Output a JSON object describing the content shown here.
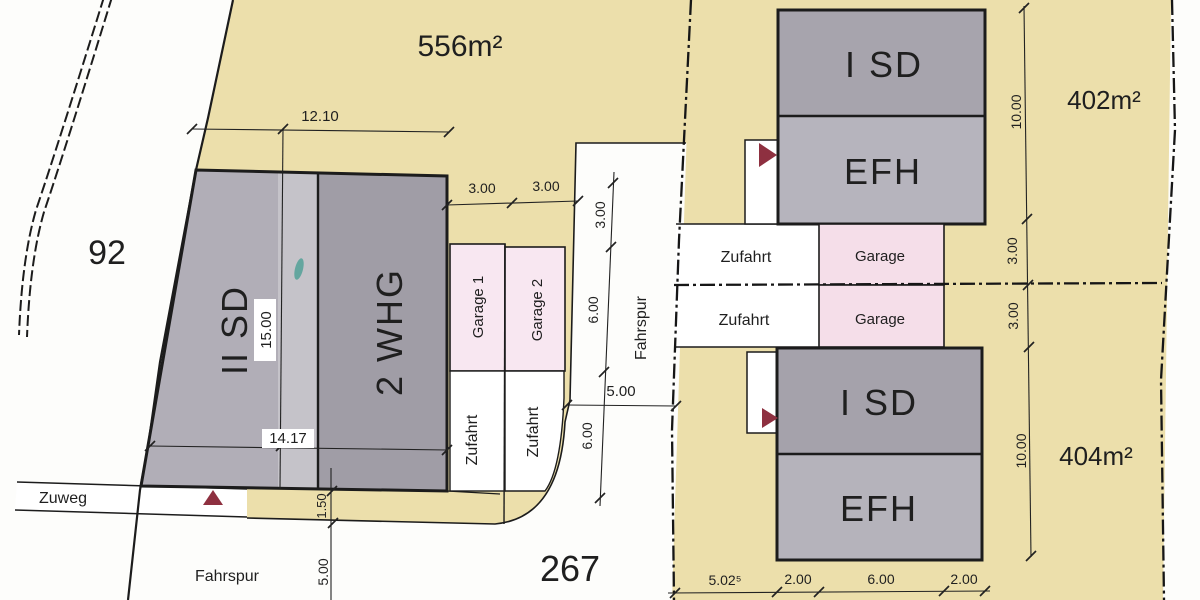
{
  "colors": {
    "parcel_beige": "#ecdfab",
    "garage_pink_left": "#f8e7f1",
    "garage_pink_right": "#f5dee9",
    "building_dark_gray": "#a09da6",
    "building_mid_gray": "#a7a4ad",
    "building_light_gray": "#b6b4bd",
    "marker_maroon": "#8e3040",
    "line_black": "#1c1c1c"
  },
  "labels": {
    "area_556": "556m²",
    "parcel_92": "92",
    "parcel_267": "267",
    "area_402": "402m²",
    "area_404": "404m²",
    "bldg_left_part1": "II SD",
    "bldg_left_part2": "2 WHG",
    "bldg_right_top_upper": "I SD",
    "bldg_right_top_lower": "EFH",
    "bldg_right_bottom_upper": "I SD",
    "bldg_right_bottom_lower": "EFH",
    "garage_left_1": "Garage 1",
    "garage_left_2": "Garage 2",
    "garage_right_1": "Garage",
    "garage_right_2": "Garage",
    "zufahrt_left_1": "Zufahrt",
    "zufahrt_left_2": "Zufahrt",
    "zufahrt_right_1": "Zufahrt",
    "zufahrt_right_2": "Zufahrt",
    "zuweg": "Zuweg",
    "fahrspur_vertical": "Fahrspur",
    "fahrspur_bottom": "Fahrspur"
  },
  "dims": {
    "top_width": "12.10",
    "garage1_width": "3.00",
    "garage2_width": "3.00",
    "building_length": "15.00",
    "bottom_width": "14.17",
    "strip_height": "1.50",
    "below_strip": "5.00",
    "lane_3": "3.00",
    "lane_6a": "6.00",
    "lane_5": "5.00",
    "lane_6b": "6.00",
    "right_10_top": "10.00",
    "right_3a": "3.00",
    "right_3b": "3.00",
    "right_10_bottom": "10.00",
    "bottom_5_02": "5.02⁵",
    "bottom_2a": "2.00",
    "bottom_6": "6.00",
    "bottom_2b": "2.00"
  }
}
